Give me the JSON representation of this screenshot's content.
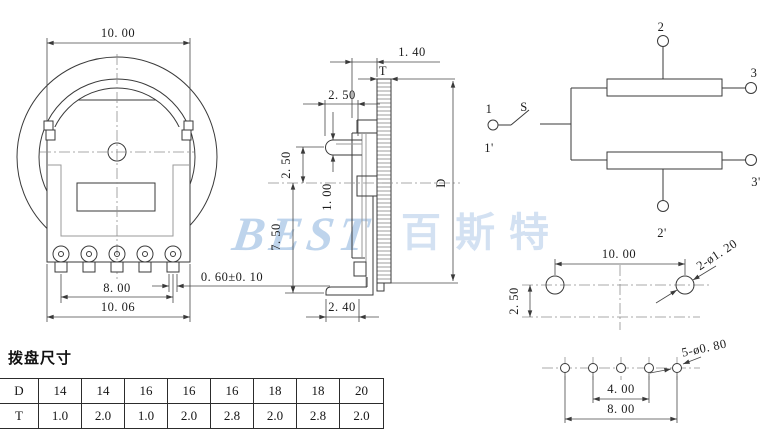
{
  "front_view": {
    "dim_top_width": "10. 00",
    "dim_pin_span": "8. 00",
    "dim_body_width": "10. 06",
    "dim_pin_width": "0. 60±0. 10"
  },
  "side_view": {
    "dim_wheel_gap": "1. 40",
    "label_thickness": "T",
    "dim_lug_protrusion": "2. 50",
    "dim_lug_offset": "2. 50",
    "dim_lug_thickness": "1. 00",
    "dim_body_height": "7. 50",
    "label_diameter": "D",
    "dim_foot_length": "2. 40"
  },
  "schematic": {
    "terminal_1": "1",
    "terminal_1b": "1'",
    "switch_label": "S",
    "terminal_2": "2",
    "terminal_3": "3",
    "terminal_2b": "2'",
    "terminal_3b": "3'"
  },
  "pcb_layout": {
    "dim_hole_span": "10. 00",
    "dim_row_offset": "2. 50",
    "note_mount_holes": "2-ø1. 20",
    "note_pin_holes": "5-ø0. 80",
    "dim_pin_inner": "4. 00",
    "dim_pin_span": "8. 00"
  },
  "dial_table": {
    "title": "拨盘尺寸",
    "row_d": {
      "label": "D",
      "values": [
        "14",
        "14",
        "16",
        "16",
        "16",
        "18",
        "18",
        "20"
      ]
    },
    "row_t": {
      "label": "T",
      "values": [
        "1.0",
        "2.0",
        "1.0",
        "2.0",
        "2.8",
        "2.0",
        "2.8",
        "2.0"
      ]
    }
  },
  "watermark": {
    "latin": "BEST",
    "chinese": "百斯特"
  },
  "colors": {
    "line": "#3a3a3a",
    "watermark_blue": "#bed4ec"
  }
}
